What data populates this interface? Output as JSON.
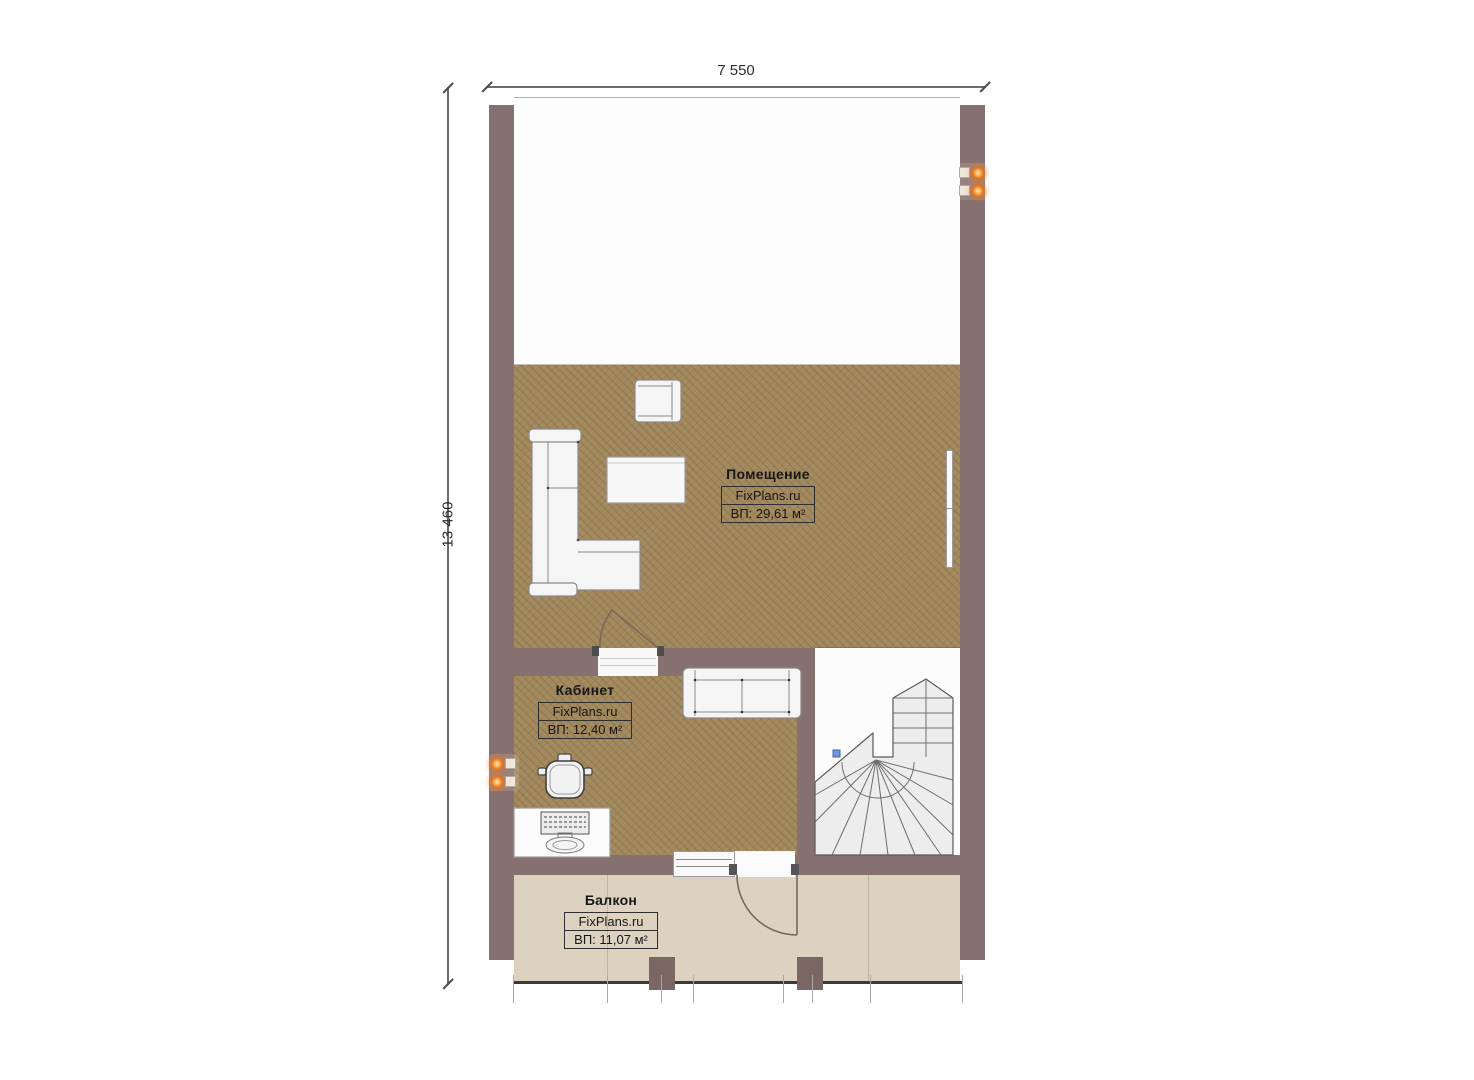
{
  "dims": {
    "width": "7 550",
    "height": "13 460"
  },
  "rooms": {
    "main": {
      "name": "Помещение",
      "brand": "FixPlans.ru",
      "area": "ВП: 29,61 м²"
    },
    "office": {
      "name": "Кабинет",
      "brand": "FixPlans.ru",
      "area": "ВП: 12,40 м²"
    },
    "balcony": {
      "name": "Балкон",
      "brand": "FixPlans.ru",
      "area": "ВП: 11,07 м²"
    }
  },
  "colors": {
    "wall": "#867170",
    "floor_main": "#a58b60",
    "floor_balcony": "#ddd2bf",
    "stair_fill": "#ededed",
    "accent_orange": "#ff8312",
    "marker_blue": "#6f96d6",
    "dim_line": "#6b6b6b"
  },
  "icons": {
    "power-socket-icon": "orange glowing dot with white plate",
    "stair-up-arrow-icon": "chevron pointing up"
  }
}
